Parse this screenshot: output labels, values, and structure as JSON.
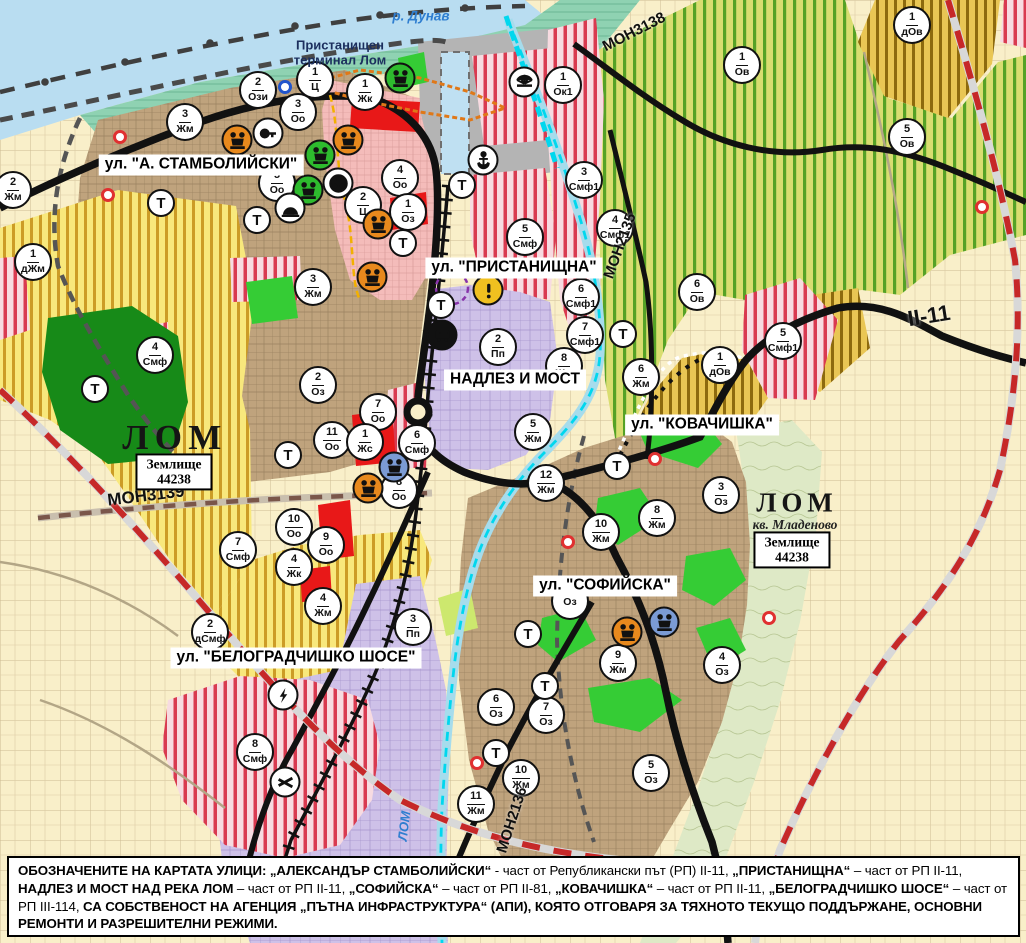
{
  "map": {
    "t_label": "Т",
    "street_labels": [
      {
        "t": "ул. \"А. СТАМБОЛИЙСКИ\"",
        "x": 201,
        "y": 165
      },
      {
        "t": "ул. \"ПРИСТАНИЩНА\"",
        "x": 514,
        "y": 268
      },
      {
        "t": "НАДЛЕЗ И МОСТ",
        "x": 515,
        "y": 380
      },
      {
        "t": "ул. \"КОВАЧИШКА\"",
        "x": 702,
        "y": 425
      },
      {
        "t": "ул. \"СОФИЙСКА\"",
        "x": 605,
        "y": 586
      },
      {
        "t": "ул. \"БЕЛОГРАДЧИШКО ШОСЕ\"",
        "x": 296,
        "y": 658
      }
    ],
    "area_labels": [
      {
        "t": "р. Дунав",
        "x": 421,
        "y": 16,
        "cls": "riv",
        "rot": 0,
        "fs": 13.5
      },
      {
        "t": "Пристанищен\nтерминал Лом",
        "x": 340,
        "y": 53,
        "cls": "port-lbl",
        "rot": 0,
        "fs": 13
      },
      {
        "t": "ЛОМ",
        "x": 175,
        "y": 438,
        "cls": "city",
        "rot": 0,
        "fs": 35
      },
      {
        "t": "ЛОМ",
        "x": 797,
        "y": 503,
        "cls": "city",
        "rot": 0,
        "fs": 27
      },
      {
        "t": "кв. Младеново",
        "x": 795,
        "y": 525,
        "cls": "kv",
        "rot": 0,
        "fs": 13.5
      },
      {
        "t": "ЛОМ",
        "x": 404,
        "y": 826,
        "cls": "riv",
        "rot": -83,
        "fs": 13
      },
      {
        "t": "МОН3139",
        "x": 146,
        "y": 496,
        "cls": "rd",
        "rot": -7,
        "fs": 17
      },
      {
        "t": "МОН3138",
        "x": 634,
        "y": 32,
        "cls": "rd",
        "rot": -27,
        "fs": 15
      },
      {
        "t": "МОН2135",
        "x": 620,
        "y": 246,
        "cls": "rd",
        "rot": -70,
        "fs": 15
      },
      {
        "t": "МОН2136",
        "x": 512,
        "y": 820,
        "cls": "rd",
        "rot": -72,
        "fs": 15
      },
      {
        "t": "II-11",
        "x": 929,
        "y": 316,
        "cls": "rd",
        "rot": -9,
        "fs": 22
      }
    ],
    "zemlishte_boxes": [
      {
        "line1": "Землище",
        "line2": "44238",
        "x": 174,
        "y": 472
      },
      {
        "line1": "Землище",
        "line2": "44238",
        "x": 792,
        "y": 550
      }
    ],
    "zone_markers": [
      {
        "num": "2",
        "code": "Ози",
        "x": 258,
        "y": 90
      },
      {
        "num": "1",
        "code": "Ц",
        "x": 315,
        "y": 80
      },
      {
        "num": "3",
        "code": "Оо",
        "x": 298,
        "y": 112
      },
      {
        "num": "1",
        "code": "Жк",
        "x": 365,
        "y": 92
      },
      {
        "num": "3",
        "code": "Жм",
        "x": 185,
        "y": 122
      },
      {
        "num": "2",
        "code": "Жм",
        "x": 13,
        "y": 190
      },
      {
        "num": "1",
        "code": "дЖм",
        "x": 33,
        "y": 262
      },
      {
        "num": "5",
        "code": "Оо",
        "x": 277,
        "y": 183
      },
      {
        "num": "4",
        "code": "Оо",
        "x": 400,
        "y": 178
      },
      {
        "num": "2",
        "code": "Ц",
        "x": 363,
        "y": 205
      },
      {
        "num": "1",
        "code": "Оз",
        "x": 408,
        "y": 212
      },
      {
        "num": "3",
        "code": "Жм",
        "x": 313,
        "y": 287
      },
      {
        "num": "1",
        "code": "Ок1",
        "x": 563,
        "y": 85
      },
      {
        "num": "1",
        "code": "Ов",
        "x": 742,
        "y": 65
      },
      {
        "num": "1",
        "code": "дОв",
        "x": 912,
        "y": 25
      },
      {
        "num": "5",
        "code": "Ов",
        "x": 907,
        "y": 137
      },
      {
        "num": "3",
        "code": "Смф1",
        "x": 584,
        "y": 180
      },
      {
        "num": "4",
        "code": "Смф1",
        "x": 615,
        "y": 228
      },
      {
        "num": "5",
        "code": "Смф",
        "x": 525,
        "y": 237
      },
      {
        "num": "6",
        "code": "Смф1",
        "x": 581,
        "y": 297
      },
      {
        "num": "7",
        "code": "Смф1",
        "x": 585,
        "y": 335
      },
      {
        "num": "6",
        "code": "Ов",
        "x": 697,
        "y": 292
      },
      {
        "num": "5",
        "code": "Смф1",
        "x": 783,
        "y": 341
      },
      {
        "num": "1",
        "code": "дОв",
        "x": 720,
        "y": 365
      },
      {
        "num": "2",
        "code": "Пп",
        "x": 498,
        "y": 347
      },
      {
        "num": "8",
        "code": "Жм",
        "x": 564,
        "y": 366
      },
      {
        "num": "5",
        "code": "Жм",
        "x": 533,
        "y": 432
      },
      {
        "num": "12",
        "code": "Жм",
        "x": 546,
        "y": 483
      },
      {
        "num": "6",
        "code": "Жм",
        "x": 641,
        "y": 377
      },
      {
        "num": "2",
        "code": "Оз",
        "x": 318,
        "y": 385
      },
      {
        "num": "7",
        "code": "Оо",
        "x": 378,
        "y": 412
      },
      {
        "num": "11",
        "code": "Оо",
        "x": 332,
        "y": 440
      },
      {
        "num": "1",
        "code": "Жс",
        "x": 365,
        "y": 442
      },
      {
        "num": "6",
        "code": "Смф",
        "x": 417,
        "y": 443
      },
      {
        "num": "8",
        "code": "Оо",
        "x": 399,
        "y": 490
      },
      {
        "num": "10",
        "code": "Оо",
        "x": 294,
        "y": 527
      },
      {
        "num": "9",
        "code": "Оо",
        "x": 326,
        "y": 545
      },
      {
        "num": "4",
        "code": "Жк",
        "x": 294,
        "y": 567
      },
      {
        "num": "7",
        "code": "Смф",
        "x": 238,
        "y": 550
      },
      {
        "num": "4",
        "code": "Жм",
        "x": 323,
        "y": 606
      },
      {
        "num": "4",
        "code": "Смф",
        "x": 155,
        "y": 355
      },
      {
        "num": "2",
        "code": "дСмф",
        "x": 210,
        "y": 632
      },
      {
        "num": "3",
        "code": "Пп",
        "x": 413,
        "y": 627
      },
      {
        "num": "8",
        "code": "Смф",
        "x": 255,
        "y": 752
      },
      {
        "num": "3",
        "code": "Оз",
        "x": 721,
        "y": 495
      },
      {
        "num": "8",
        "code": "Жм",
        "x": 657,
        "y": 518
      },
      {
        "num": "10",
        "code": "Жм",
        "x": 601,
        "y": 532
      },
      {
        "num": "9",
        "code": "Жм",
        "x": 618,
        "y": 663
      },
      {
        "num": "4",
        "code": "Оз",
        "x": 722,
        "y": 665
      },
      {
        "num": "6",
        "code": "Оз",
        "x": 496,
        "y": 707
      },
      {
        "num": "7",
        "code": "Оз",
        "x": 546,
        "y": 715
      },
      {
        "num": "10",
        "code": "Жм",
        "x": 521,
        "y": 778
      },
      {
        "num": "11",
        "code": "Жм",
        "x": 476,
        "y": 804
      },
      {
        "num": "5",
        "code": "Оз",
        "x": 651,
        "y": 773
      },
      {
        "num": "",
        "code": "Оз",
        "x": 570,
        "y": 601
      }
    ],
    "t_markers": [
      {
        "x": 161,
        "y": 203
      },
      {
        "x": 257,
        "y": 220
      },
      {
        "x": 403,
        "y": 243
      },
      {
        "x": 462,
        "y": 185
      },
      {
        "x": 95,
        "y": 389
      },
      {
        "x": 288,
        "y": 455
      },
      {
        "x": 441,
        "y": 305
      },
      {
        "x": 623,
        "y": 334
      },
      {
        "x": 617,
        "y": 466
      },
      {
        "x": 528,
        "y": 634
      },
      {
        "x": 545,
        "y": 686
      },
      {
        "x": 496,
        "y": 753
      }
    ],
    "icon_markers": [
      {
        "type": "culture-monument",
        "color": "#e8891d",
        "x": 237,
        "y": 140
      },
      {
        "type": "culture-monument",
        "color": "#e8891d",
        "x": 348,
        "y": 140
      },
      {
        "type": "culture-monument",
        "color": "#e8891d",
        "x": 378,
        "y": 224
      },
      {
        "type": "culture-monument",
        "color": "#e8891d",
        "x": 372,
        "y": 277
      },
      {
        "type": "culture-monument",
        "color": "#e8891d",
        "x": 368,
        "y": 488
      },
      {
        "type": "culture-monument",
        "color": "#e8891d",
        "x": 627,
        "y": 632
      },
      {
        "type": "culture-monument",
        "color": "#2ebb2e",
        "x": 320,
        "y": 155
      },
      {
        "type": "culture-monument",
        "color": "#2ebb2e",
        "x": 308,
        "y": 190
      },
      {
        "type": "culture-monument",
        "color": "#2ebb2e",
        "x": 400,
        "y": 78
      },
      {
        "type": "culture-monument",
        "color": "#7b9bd4",
        "x": 394,
        "y": 467
      },
      {
        "type": "culture-monument",
        "color": "#7b9bd4",
        "x": 664,
        "y": 622
      },
      {
        "type": "key",
        "color": "#ffffff",
        "x": 268,
        "y": 133
      },
      {
        "type": "community",
        "color": "#ffffff",
        "x": 338,
        "y": 183
      },
      {
        "type": "tunnel",
        "color": "#ffffff",
        "x": 290,
        "y": 208
      },
      {
        "type": "anchor",
        "color": "#ffffff",
        "x": 483,
        "y": 160
      },
      {
        "type": "port-crane",
        "color": "#ffffff",
        "x": 524,
        "y": 82
      },
      {
        "type": "warning",
        "color": "#f0c020",
        "x": 488,
        "y": 290
      },
      {
        "type": "bus-station",
        "color": "#111111",
        "x": 442,
        "y": 335
      },
      {
        "type": "power",
        "color": "#ffffff",
        "x": 283,
        "y": 695
      },
      {
        "type": "rail-crossing",
        "color": "#ffffff",
        "x": 285,
        "y": 782
      },
      {
        "type": "red-point",
        "color": "#e03030",
        "x": 120,
        "y": 137
      },
      {
        "type": "red-point",
        "color": "#e03030",
        "x": 108,
        "y": 195
      },
      {
        "type": "red-point",
        "color": "#e03030",
        "x": 982,
        "y": 207
      },
      {
        "type": "red-point",
        "color": "#e03030",
        "x": 655,
        "y": 459
      },
      {
        "type": "red-point",
        "color": "#e03030",
        "x": 568,
        "y": 542
      },
      {
        "type": "red-point",
        "color": "#e03030",
        "x": 769,
        "y": 618
      },
      {
        "type": "red-point",
        "color": "#e03030",
        "x": 477,
        "y": 763
      },
      {
        "type": "blue-point",
        "color": "#2255cc",
        "x": 285,
        "y": 87
      }
    ],
    "note": {
      "segments": [
        {
          "b": 1,
          "t": "ОБОЗНАЧЕНИТЕ НА КАРТАТА УЛИЦИ: „АЛЕКСАНДЪР СТАМБОЛИЙСКИ“"
        },
        {
          "b": 0,
          "t": " - част от Републикански път (РП) II-11, "
        },
        {
          "b": 1,
          "t": "„ПРИСТАНИЩНА“"
        },
        {
          "b": 0,
          "t": " – част от РП II-11, "
        },
        {
          "b": 1,
          "t": "НАДЛЕЗ И МОСТ НАД РЕКА ЛОМ"
        },
        {
          "b": 0,
          "t": " – част от РП II-11, "
        },
        {
          "b": 1,
          "t": "„СОФИЙСКА“"
        },
        {
          "b": 0,
          "t": " – част от РП II-81, "
        },
        {
          "b": 1,
          "t": "„КОВАЧИШКА“"
        },
        {
          "b": 0,
          "t": " – част от РП II-11, "
        },
        {
          "b": 1,
          "t": "„БЕЛОГРАДЧИШКО ШОСЕ“"
        },
        {
          "b": 0,
          "t": " – част от РП III-114, "
        },
        {
          "b": 1,
          "t": "СА СОБСТВЕНОСТ НА АГЕНЦИЯ „ПЪТНА ИНФРАСТРУКТУРА“ (АПИ), КОЯТО ОТГОВАРЯ ЗА ТЯХНОТО ТЕКУЩО ПОДДЪРЖАНЕ, ОСНОВНИ РЕМОНТИ И РАЗРЕШИТЕЛНИ РЕЖИМИ."
        }
      ]
    }
  },
  "legend_colors": {
    "water": "#b9ddf1",
    "river_channel": "#00d7ee",
    "residential_tan": "#bfa37d",
    "agriculture_yellow": "#f8e87c",
    "vineyard_green": "#d9dd70",
    "mixed_function_red": "#d93a50",
    "industrial_lavender": "#cec1e8",
    "center_pink": "#f4bcba",
    "port_gray": "#b4b4b4",
    "park_green": "#35cc35",
    "farmland_cream": "#f9efc9",
    "road_black": "#111111",
    "boundary_red_dash": "#c62828"
  }
}
